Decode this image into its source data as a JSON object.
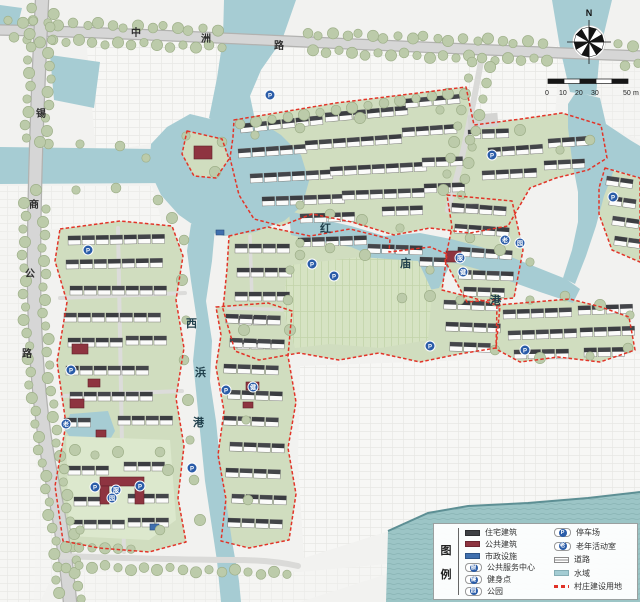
{
  "map": {
    "road_top": {
      "name": "中洲路",
      "chars": [
        "中",
        "洲",
        "路"
      ]
    },
    "road_left": {
      "name": "锡商公路",
      "chars": [
        "锡",
        "商",
        "公",
        "路"
      ]
    },
    "river_east": {
      "name": "红庙港",
      "chars": [
        "红",
        "庙",
        "港"
      ]
    },
    "river_south": {
      "name": "西浜港",
      "chars": [
        "西",
        "浜",
        "港"
      ]
    },
    "compass_north": "N",
    "scale": {
      "ticks": [
        "0",
        "10",
        "20",
        "30",
        "50"
      ],
      "unit": "m"
    },
    "icon_letters": {
      "parking": "P",
      "service": "服",
      "fitness": "健",
      "park": "园",
      "elderly": "老"
    }
  },
  "legend": {
    "title_chars": [
      "图",
      "例"
    ],
    "left_items": [
      {
        "label": "住宅建筑",
        "type": "swatch-residential",
        "color": "#3e4044"
      },
      {
        "label": "公共建筑",
        "type": "swatch-public",
        "color": "#8e3440"
      },
      {
        "label": "市政设施",
        "type": "swatch-municipal",
        "color": "#3f6fae"
      },
      {
        "label": "公共服务中心",
        "type": "icon",
        "letter": "服"
      },
      {
        "label": "健身点",
        "type": "icon",
        "letter": "健"
      },
      {
        "label": "公园",
        "type": "icon",
        "letter": "园"
      }
    ],
    "right_items": [
      {
        "label": "停车场",
        "type": "icon",
        "letter": "P"
      },
      {
        "label": "老年活动室",
        "type": "icon",
        "letter": "老"
      },
      {
        "label": "道路",
        "type": "road-swatch"
      },
      {
        "label": "水域",
        "type": "water-swatch",
        "color": "#a3ccd3"
      },
      {
        "label": "村庄建设用地",
        "type": "red-dash",
        "color": "#e23428"
      }
    ]
  },
  "colors": {
    "water": "#a6ccd3",
    "water_bottom": "#9cc5c6",
    "village_green": "#d0ddbf",
    "boundary_red": "#e23428",
    "residential_roof": "#44464a",
    "public_building": "#8e3440",
    "municipal": "#3f6fae",
    "icon_blue": "#2a5ca8",
    "road_gray": "#d6d6d6",
    "tree_green": "#bccbaa"
  }
}
